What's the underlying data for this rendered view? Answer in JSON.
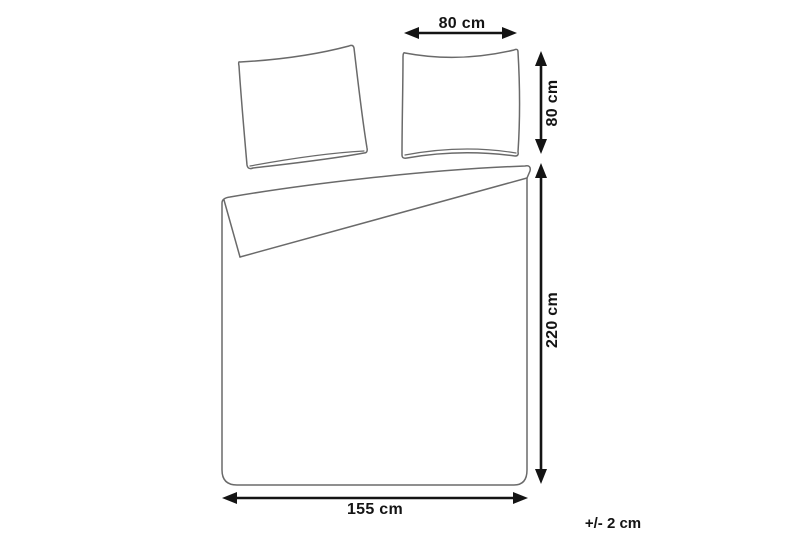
{
  "diagram": {
    "kind": "bedding-set-dimension-diagram",
    "background_color": "#ffffff",
    "outline_color": "#6a6a6a",
    "dimension_color": "#141414",
    "objects": {
      "pillowcase_left": "pillowcase (tilted)",
      "pillowcase_right": "pillowcase",
      "duvet_cover": "duvet cover with folded-back top corner"
    },
    "dimensions": {
      "pillow_width": {
        "label": "80 cm",
        "value": 80,
        "unit": "cm",
        "orientation": "horizontal",
        "applies_to": "pillowcase"
      },
      "pillow_height": {
        "label": "80 cm",
        "value": 80,
        "unit": "cm",
        "orientation": "vertical",
        "applies_to": "pillowcase"
      },
      "duvet_length": {
        "label": "220 cm",
        "value": 220,
        "unit": "cm",
        "orientation": "vertical",
        "applies_to": "duvet_cover"
      },
      "duvet_width": {
        "label": "155 cm",
        "value": 155,
        "unit": "cm",
        "orientation": "horizontal",
        "applies_to": "duvet_cover"
      },
      "tolerance": {
        "label": "+/- 2 cm",
        "value": 2,
        "unit": "cm"
      }
    }
  }
}
